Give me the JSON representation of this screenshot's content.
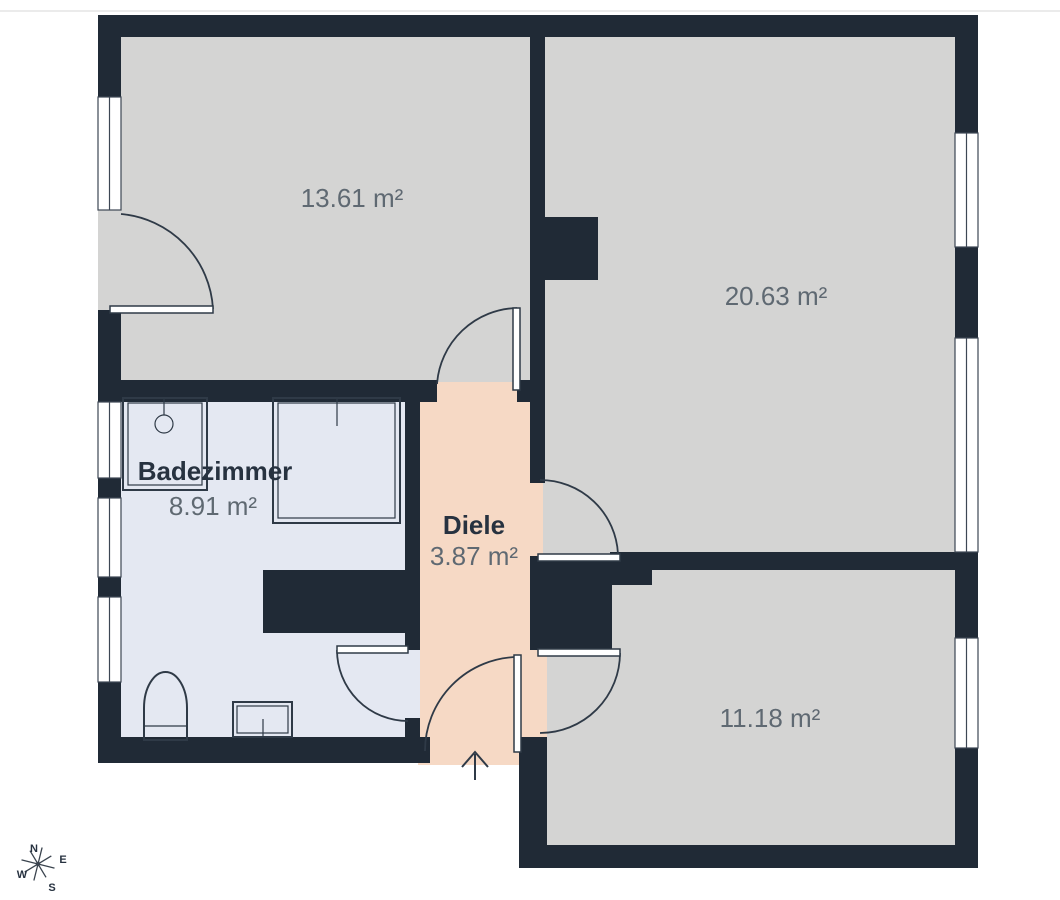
{
  "palette": {
    "wall": "#202a36",
    "floor_gray": "#d4d4d3",
    "floor_bath": "#e4e8f2",
    "floor_hall": "#f6d9c5",
    "line": "#2f3a47",
    "window_stroke": "#3d4754",
    "window_fill": "#ffffff",
    "text_muted": "#5f6972",
    "text_dark": "#273240",
    "page_bg": "#ffffff",
    "top_rule": "#ebebeb"
  },
  "rooms": [
    {
      "id": "room-top-left",
      "area_label": "13.61 m²"
    },
    {
      "id": "room-top-right",
      "area_label": "20.63 m²"
    },
    {
      "id": "bathroom",
      "name_label": "Badezimmer",
      "area_label": "8.91 m²"
    },
    {
      "id": "hallway",
      "name_label": "Diele",
      "area_label": "3.87 m²"
    },
    {
      "id": "room-bottom-right",
      "area_label": "11.18 m²"
    }
  ],
  "compass": {
    "north": "N",
    "east": "E",
    "west": "W",
    "south": "S"
  }
}
